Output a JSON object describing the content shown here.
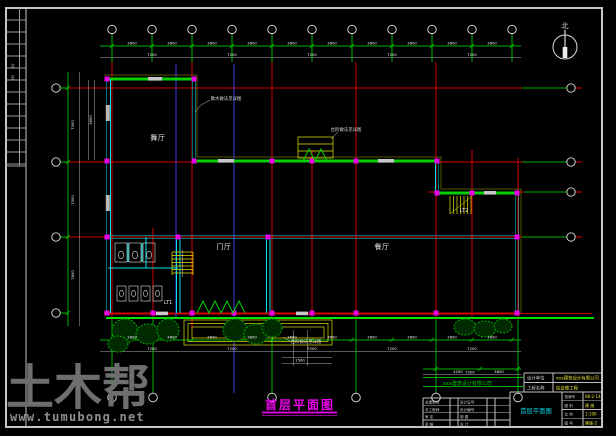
{
  "colors": {
    "axis_red": "#d60000",
    "wall_green": "#00d200",
    "dim_green": "#00b000",
    "wall_cyan": "#00e5e5",
    "detail_yellow": "#e6e600",
    "column_magenta": "#e800e8",
    "ref_blue": "#4040e0",
    "title_magenta": "#f000f0",
    "value_yellow": "#e8e83a",
    "watermark_gray": "#6e6e6e"
  },
  "sheet": {
    "watermark_logo": "土木帮",
    "watermark_url": "www.tumubong.net",
    "strip_label_1": "会",
    "strip_label_2": "签"
  },
  "north": {
    "label": "北"
  },
  "rooms": {
    "hall_upper": "舞厅",
    "entry": "门厅",
    "dining": "餐厅",
    "stair1": "LT1",
    "stair2": "LT2"
  },
  "notes": {
    "apron": "散水做法见详图",
    "steps_top": "台阶做法见详图",
    "steps_bottom": "台阶做法见详图"
  },
  "drawing_title": {
    "text": "首层平面图"
  },
  "title_block": {
    "company_green": "xxx建筑设计有限公司",
    "upper": [
      {
        "label": "设计单位",
        "value": "xxx建筑设计有限公司"
      },
      {
        "label": "工程名称",
        "value": "综合楼工程"
      }
    ],
    "left_rows": [
      [
        "总建筑师",
        "设计证号"
      ],
      [
        "总工程师",
        "设计编号"
      ],
      [
        "审  定",
        "制  图"
      ],
      [
        "审  核",
        "设  计"
      ]
    ],
    "drawing_name": "首层平面图",
    "right_rows": [
      {
        "label": "档案号",
        "value": "08-2-14"
      },
      {
        "label": "图 别",
        "value": "建 施"
      },
      {
        "label": "比 例",
        "value": "1:100"
      },
      {
        "label": "图 号",
        "value": "建施-2"
      }
    ]
  },
  "dims": {
    "d3600": "3600",
    "d7200": "7200",
    "v1": "7500",
    "v2": "7500",
    "v3": "7600",
    "c1": "1500",
    "c2": "4200",
    "c3": "3800"
  }
}
